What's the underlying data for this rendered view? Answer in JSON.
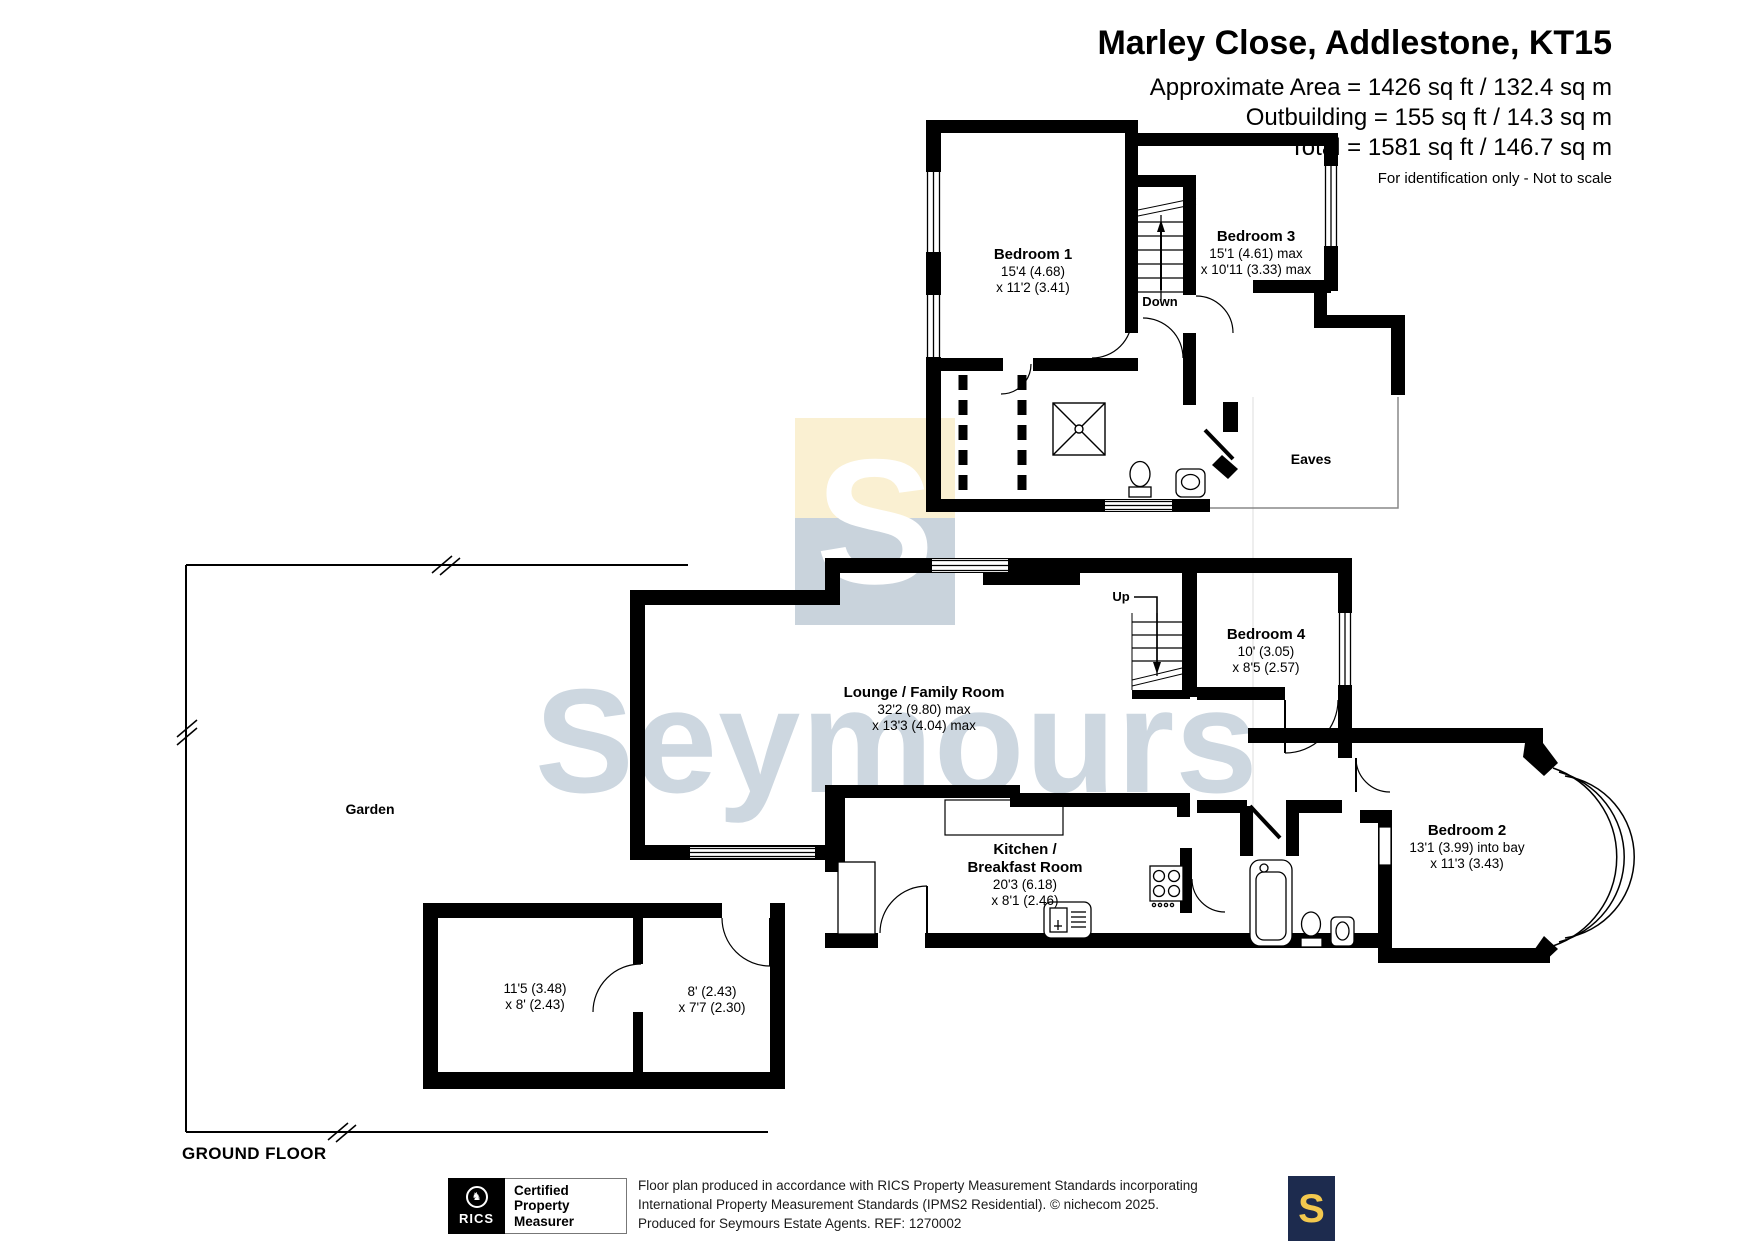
{
  "header": {
    "title": "Marley Close, Addlestone, KT15",
    "area1": "Approximate Area = 1426 sq ft / 132.4 sq m",
    "area2": "Outbuilding = 155 sq ft / 14.3 sq m",
    "area3": "Total = 1581 sq ft / 146.7 sq m",
    "note": "For identification only - Not to scale"
  },
  "rooms": {
    "bedroom1": {
      "name": "Bedroom 1",
      "dim1": "15'4 (4.68)",
      "dim2": "x 11'2 (3.41)"
    },
    "bedroom3": {
      "name": "Bedroom 3",
      "dim1": "15'1 (4.61) max",
      "dim2": "x 10'11 (3.33) max"
    },
    "bedroom4": {
      "name": "Bedroom 4",
      "dim1": "10' (3.05)",
      "dim2": "x 8'5 (2.57)"
    },
    "bedroom2": {
      "name": "Bedroom 2",
      "dim1": "13'1 (3.99) into bay",
      "dim2": "x 11'3 (3.43)"
    },
    "lounge": {
      "name": "Lounge / Family Room",
      "dim1": "32'2 (9.80) max",
      "dim2": "x 13'3 (4.04) max"
    },
    "kitchen": {
      "line1": "Kitchen /",
      "line2": "Breakfast Room",
      "dim1": "20'3 (6.18)",
      "dim2": "x 8'1 (2.46)"
    },
    "eaves": {
      "label": "Eaves"
    },
    "garden": {
      "label": "Garden"
    }
  },
  "outbuilding": {
    "left": {
      "dim1": "11'5 (3.48)",
      "dim2": "x 8' (2.43)"
    },
    "right": {
      "dim1": "8' (2.43)",
      "dim2": "x 7'7 (2.30)"
    }
  },
  "stairs": {
    "down": "Down",
    "up": "Up"
  },
  "ground_floor_label": "GROUND FLOOR",
  "watermark": {
    "text": "Seymours",
    "letter": "S"
  },
  "footer": {
    "rics_brand": "RICS",
    "cert1": "Certified",
    "cert2": "Property",
    "cert3": "Measurer",
    "line1": "Floor plan produced in accordance with RICS Property Measurement Standards incorporating",
    "line2": "International Property Measurement Standards (IPMS2 Residential).   © nichecom 2025.",
    "line3": "Produced for Seymours Estate Agents.   REF:  1270002",
    "logo_letter": "S"
  },
  "colors": {
    "wall": "#000000",
    "watermark_text": "#cdd7e0",
    "watermark_yellow": "#faf0d2",
    "watermark_steel": "#c9d3dc",
    "brand_navy": "#1d2b4e",
    "brand_gold": "#f3c84e"
  }
}
